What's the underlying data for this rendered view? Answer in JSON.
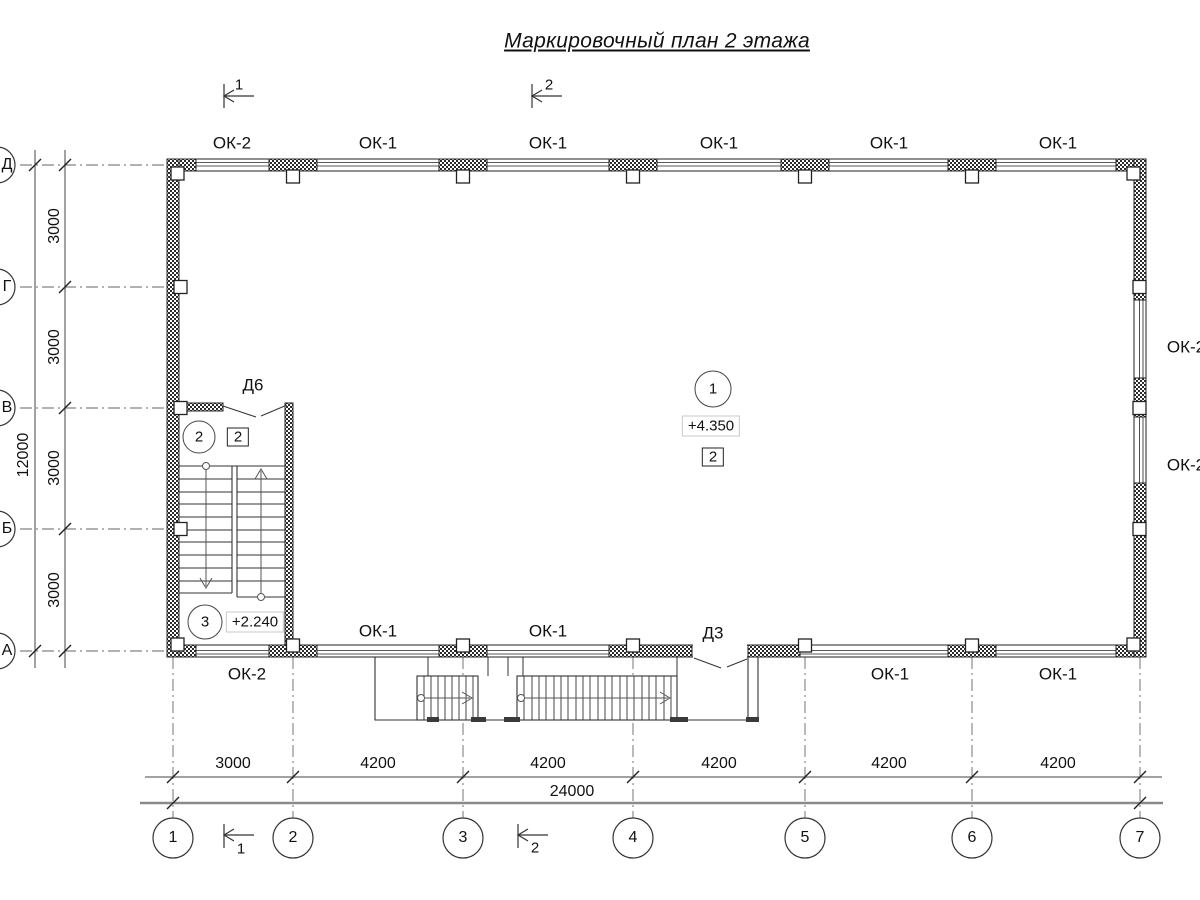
{
  "title": "Маркировочный план 2 этажа",
  "section_marks": {
    "s1": "1",
    "s2": "2"
  },
  "top_windows": [
    "ОК-2",
    "ОК-1",
    "ОК-1",
    "ОК-1",
    "ОК-1",
    "ОК-1"
  ],
  "bottom_outside_windows": [
    "ОК-2",
    "ОК-1",
    "ОК-1"
  ],
  "bottom_inside_windows": [
    "ОК-1",
    "ОК-1"
  ],
  "right_windows": [
    "ОК-2",
    "ОК-2"
  ],
  "doors": {
    "d6": "Д6",
    "d3": "Д3"
  },
  "rooms": {
    "r1": {
      "num": "1",
      "elev": "+4.350",
      "finish": "2"
    },
    "r2": {
      "num": "2",
      "finish": "2"
    },
    "r3": {
      "num": "3",
      "elev": "+2.240"
    }
  },
  "axes": {
    "cols": [
      "1",
      "2",
      "3",
      "4",
      "5",
      "6",
      "7"
    ],
    "rows": [
      "Д",
      "Г",
      "В",
      "Б",
      "А"
    ]
  },
  "dims": {
    "col": [
      "3000",
      "4200",
      "4200",
      "4200",
      "4200",
      "4200"
    ],
    "col_total": "24000",
    "row": [
      "3000",
      "3000",
      "3000",
      "3000"
    ],
    "row_total": "12000"
  }
}
